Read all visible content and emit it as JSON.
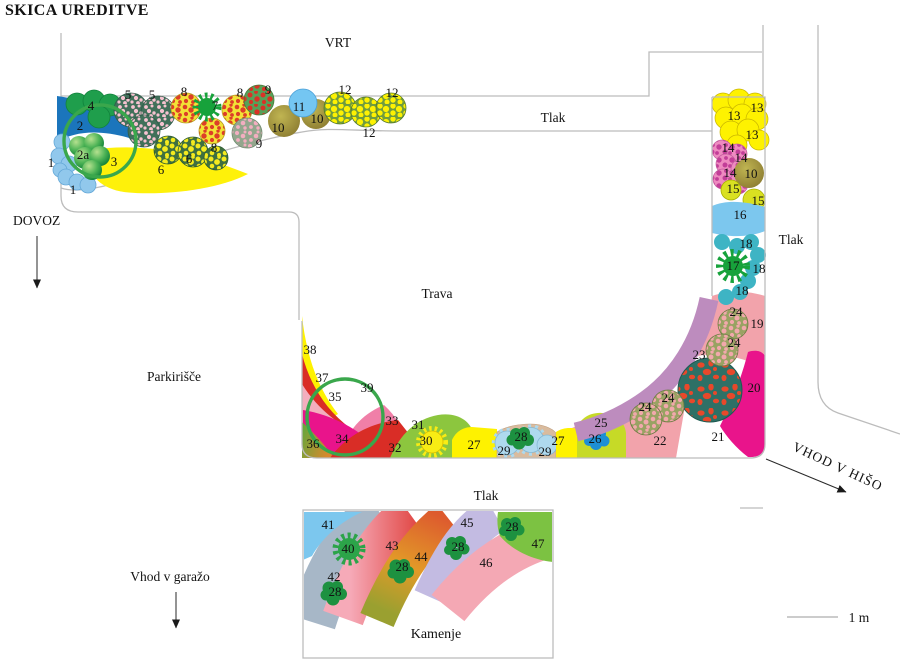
{
  "title": "SKICA UREDITVE",
  "areas": {
    "vrt": "VRT",
    "tlak": "Tlak",
    "trava": "Trava",
    "parkirisce": "Parkirišče",
    "dovoz": "DOVOZ",
    "vhod_v_hiso": "VHOD V HIŠO",
    "vhod_v_garazo": "Vhod v garažo",
    "kamenje": "Kamenje",
    "scale_label": "1 m"
  },
  "plants": {
    "p1": "1",
    "p2": "2",
    "p2a": "2a",
    "p3": "3",
    "p4": "4",
    "p5": "5",
    "p6": "6",
    "p7": "7",
    "p8": "8",
    "p9": "9",
    "p10": "10",
    "p11": "11",
    "p12": "12",
    "p13": "13",
    "p14": "14",
    "p15": "15",
    "p16": "16",
    "p17": "17",
    "p18": "18",
    "p19": "19",
    "p20": "20",
    "p21": "21",
    "p22": "22",
    "p23": "23",
    "p24": "24",
    "p25": "25",
    "p26": "26",
    "p27": "27",
    "p28": "28",
    "p29": "29",
    "p30": "30",
    "p31": "31",
    "p32": "32",
    "p33": "33",
    "p34": "34",
    "p35": "35",
    "p36": "36",
    "p37": "37",
    "p38": "38",
    "p39": "39",
    "p40": "40",
    "p41": "41",
    "p42": "42",
    "p43": "43",
    "p44": "44",
    "p45": "45",
    "p46": "46",
    "p47": "47"
  },
  "colors": {
    "outline_gray": "#bcbcbc",
    "ring_green": "#3aa74c",
    "yellow": "#fef200",
    "magenta": "#e9148b",
    "salmon": "#f2a3ab",
    "mauve": "#bd8cbe",
    "sky_blue": "#7cc7ee",
    "blue": "#1b75bc",
    "teal": "#3eb4c4",
    "red": "#d92d26",
    "green": "#1f9e4c",
    "lime": "#8cc63e",
    "olive": "#a89f42",
    "lavender": "#c3bbe2",
    "blue_gray": "#a7b7c7",
    "pink": "#f07fa8",
    "light_pink": "#f3aebe",
    "dark_blob_green": "#1d9140",
    "azure": "#1e8fd4"
  }
}
